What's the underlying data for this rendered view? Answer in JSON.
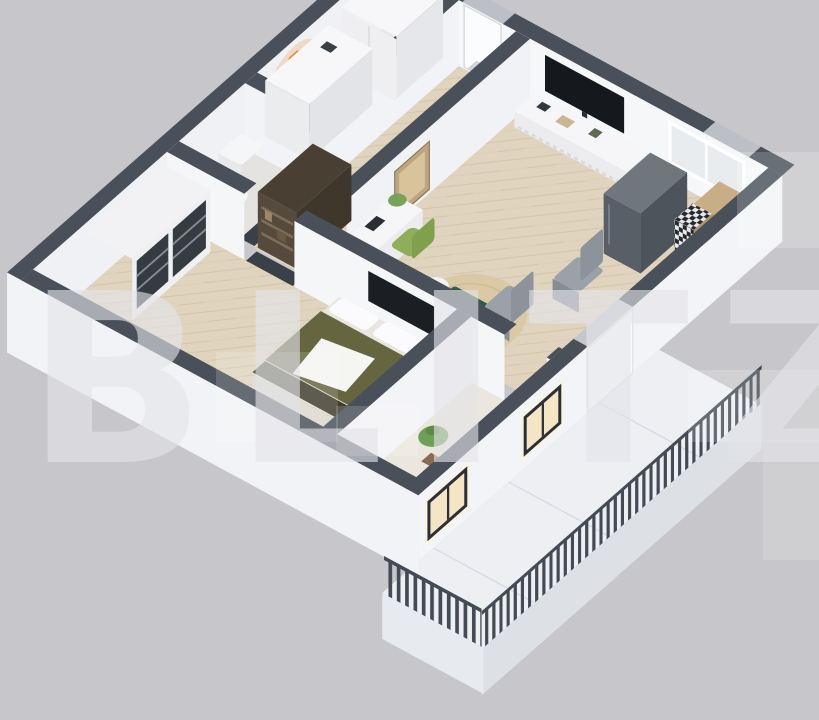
{
  "watermark": {
    "text": "BLITZ"
  },
  "scene": {
    "type": "isometric-floor-plan-render",
    "rooms": [
      "entry",
      "bathroom",
      "hallway",
      "living-room",
      "kitchen",
      "bedroom",
      "study",
      "balcony"
    ],
    "furniture": [
      "entry-wardrobe",
      "entry-fridge",
      "wall-lamp",
      "shelf-unit",
      "wall-tv",
      "media-console",
      "desk",
      "desk-chair",
      "leaning-frames",
      "round-rug",
      "coffee-table",
      "pouf",
      "side-table",
      "dining-chairs",
      "kitchen-fridge",
      "kitchen-table",
      "bar-chairs",
      "sink-counter",
      "bed",
      "bedroom-wardrobe",
      "bedroom-tv-panel",
      "plant",
      "ac-unit",
      "balcony-railing"
    ],
    "colors": {
      "bg": "#c7c7cb",
      "wall_top": "#49505a",
      "wall_face": "#f2f3f6",
      "face_bright": "#f6f7f9",
      "wood": "#e0d4bf",
      "wood_line": "#c9b99c",
      "floor_light": "#e9e8e4",
      "study_floor": "#ebe7de",
      "balcony": "#edeff3",
      "slab": "#dde0e5",
      "railing": "#454b54",
      "tv": "#15181d",
      "bed_olive": "#656540",
      "bed_dark": "#3f3d2d",
      "table_green": "#2f5d4c",
      "pouf_orange": "#cf6527",
      "chair_green": "#8fae5a",
      "lamp_orange": "#e8872b",
      "glow": "#f4e6c4",
      "counter_wood": "#c9ad85",
      "fridge": "#595f67",
      "shelf_wood": "#564a3c",
      "gray_chair": "#9ba1a8",
      "watermark": "#e4e4e8"
    }
  }
}
